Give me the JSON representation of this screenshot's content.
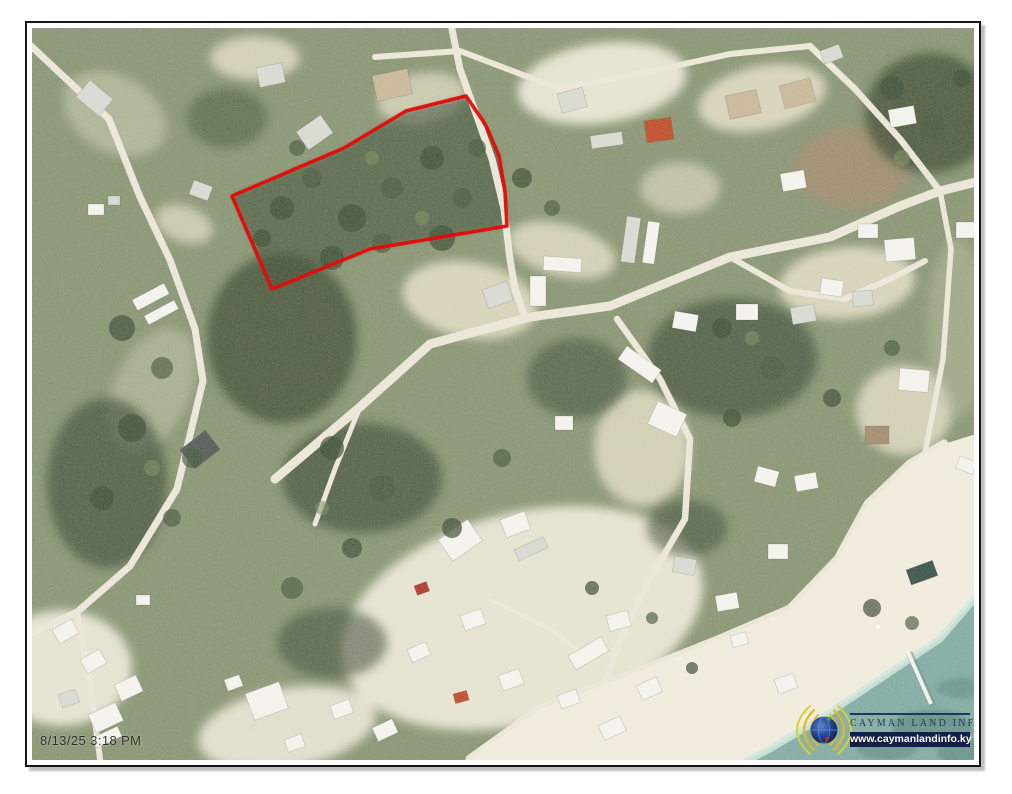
{
  "document": {
    "type": "aerial parcel map export",
    "timestamp": "8/13/25 3:18 PM"
  },
  "map": {
    "timestamp": "8/13/25 3:18 PM",
    "parcel_outline": {
      "color": "#e60a0a",
      "stroke_width": 3.6,
      "points": "434,68 374,83 312,120 200,168 240,261 338,221 475,198 473,164 467,128 455,100 451,93"
    },
    "colors": {
      "vegetation_base": "#8d9877",
      "vegetation_dark": "#43523a",
      "scrub_light": "#b5bb9e",
      "sand": "#e6dfc8",
      "sand_bright": "#f1ecdd",
      "road": "#ece7d8",
      "sea": "#83aca3",
      "sea_deep": "#55827a",
      "foam": "#cfe8dd",
      "house_white": "#f4f3ee",
      "house_gray": "#d9dad3",
      "roof_orange": "#bf4f2c",
      "roof_tan": "#c9b89a",
      "roof_dark": "#565e59",
      "roof_green": "#3c564b",
      "roof_red": "#b23a2e",
      "debris_brown": "#a28e72"
    }
  },
  "branding": {
    "name": "CAYMAN LAND INFO",
    "url": "www.caymanlandinfo.ky",
    "navy": "#23355e",
    "banner": "#131f49",
    "banner_text": "#fffdf0",
    "arc_gold": "#e0ba1f",
    "globe_blue": "#16347c"
  }
}
